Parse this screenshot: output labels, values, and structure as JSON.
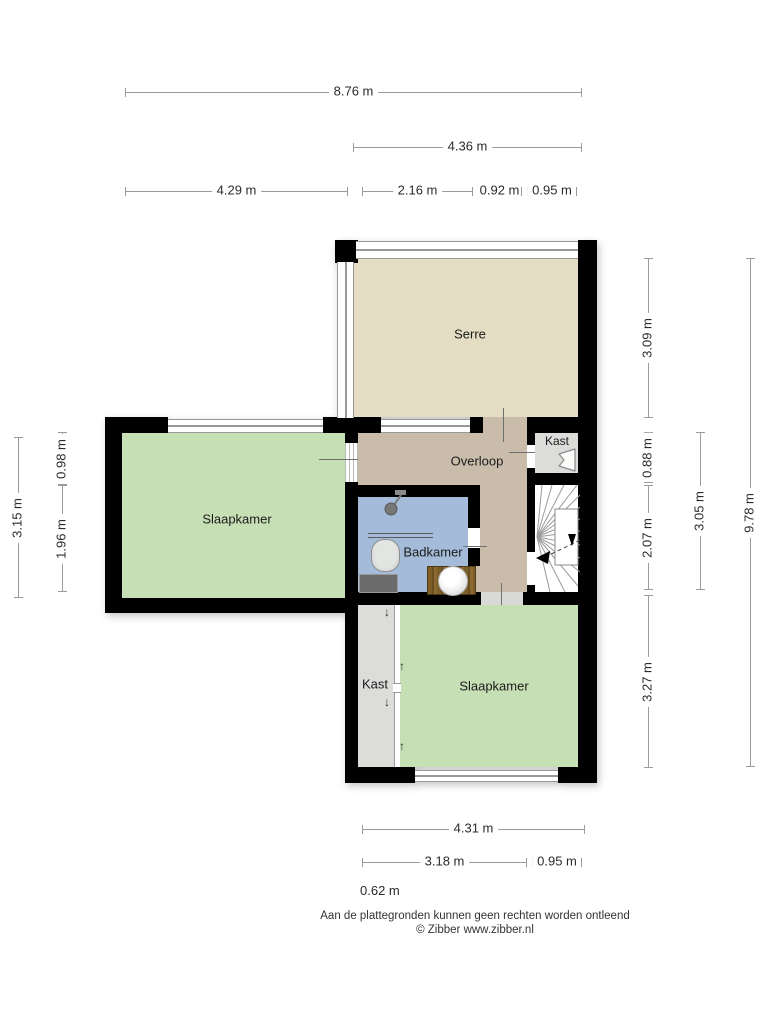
{
  "plan": {
    "rooms": {
      "serre": {
        "label": "Serre"
      },
      "overloop": {
        "label": "Overloop"
      },
      "badkamer": {
        "label": "Badkamer"
      },
      "kast_boven": {
        "label": "Kast"
      },
      "slaapkamer_links": {
        "label": "Slaapkamer"
      },
      "kast_onder": {
        "label": "Kast"
      },
      "slaapkamer_onder": {
        "label": "Slaapkamer"
      }
    },
    "dimensions": {
      "top": [
        {
          "value": "8.76 m"
        },
        {
          "value": "4.36 m"
        },
        {
          "value": "4.29 m"
        },
        {
          "value": "2.16 m"
        },
        {
          "value": "0.92 m"
        },
        {
          "value": "0.95 m"
        }
      ],
      "left": [
        {
          "value": "3.15 m"
        },
        {
          "value": "0.98 m"
        },
        {
          "value": "1.96 m"
        }
      ],
      "right": [
        {
          "value": "3.09 m"
        },
        {
          "value": "0.88 m"
        },
        {
          "value": "2.07 m"
        },
        {
          "value": "3.27 m"
        },
        {
          "value": "3.05 m"
        },
        {
          "value": "9.78 m"
        }
      ],
      "bottom": [
        {
          "value": "4.31 m"
        },
        {
          "value": "3.18 m"
        },
        {
          "value": "0.95 m"
        },
        {
          "value": "0.62 m"
        }
      ]
    },
    "icons": {
      "arrow_down": "↓",
      "arrow_up": "↑"
    },
    "colors": {
      "wall": "#000000",
      "serre_floor": "#e4ddc4",
      "overloop_floor": "#c9bcab",
      "slaapkamer_floor": "#c6dfb5",
      "badkamer_floor": "#a4bcda",
      "kast_floor": "#dcdcda",
      "dimension_line": "#9b9b9b"
    }
  },
  "footer": {
    "disclaimer": "Aan de plattegronden kunnen geen rechten worden ontleend",
    "copyright": "© Zibber www.zibber.nl"
  }
}
